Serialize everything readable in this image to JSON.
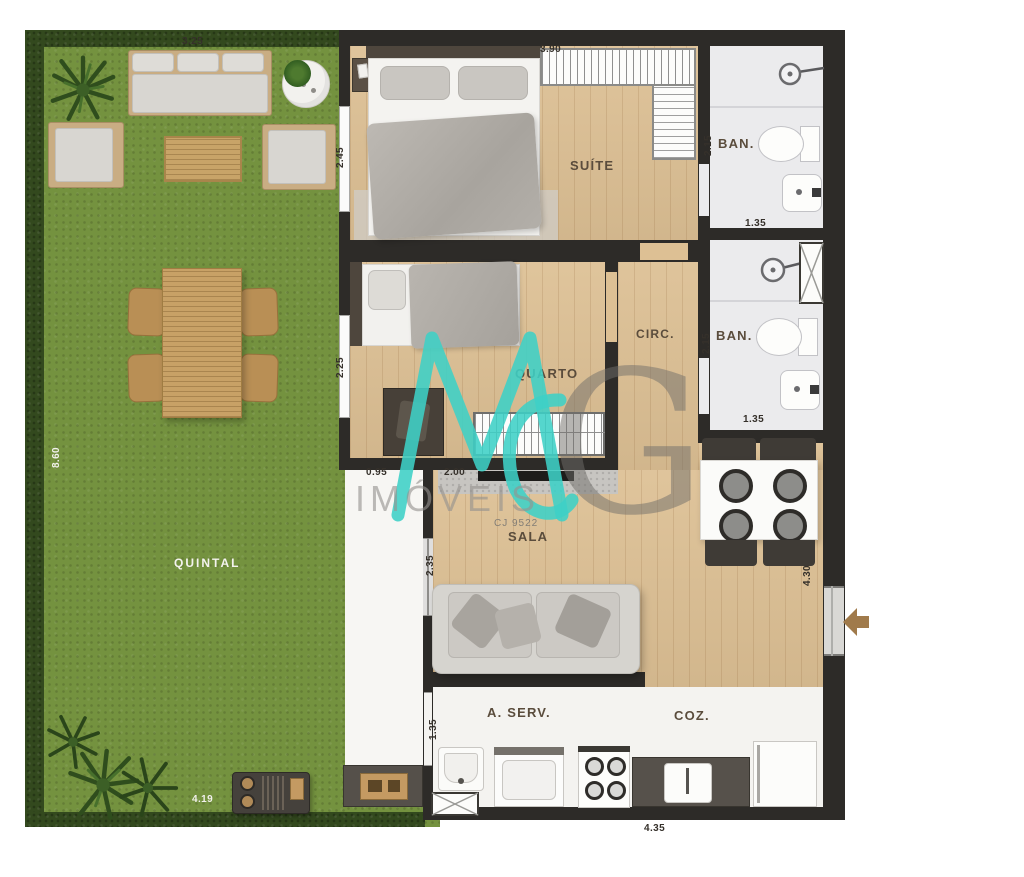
{
  "watermark": {
    "monogram_m": "M",
    "monogram_g": "G",
    "brand": "IMÓVEIS",
    "license": "CJ 9522",
    "teal": "#3ed0c6",
    "gray": "#8f8d8a"
  },
  "rooms": {
    "yard": "QUINTAL",
    "suite": "SUÍTE",
    "suite_bath": "BAN.",
    "bedroom": "QUARTO",
    "circulation": "CIRC.",
    "social_bath": "BAN.",
    "living": "SALA",
    "service": "A. SERV.",
    "kitchen": "COZ."
  },
  "dimensions": {
    "yard_top": "3.25",
    "yard_left": "8.60",
    "yard_bottom": "4.19",
    "suite_top": "3.90",
    "suite_left": "2.45",
    "suite_bath_left": "2.15",
    "suite_bath_bottom": "1.35",
    "bedroom_left": "2.25",
    "social_bath_left": "2.15",
    "social_bath_bottom": "1.35",
    "walkway_width": "0.95",
    "tv_wall": "2.00",
    "living_left": "2.35",
    "living_right": "4.30",
    "service_left": "1.35",
    "kitchen_bottom": "4.35"
  }
}
